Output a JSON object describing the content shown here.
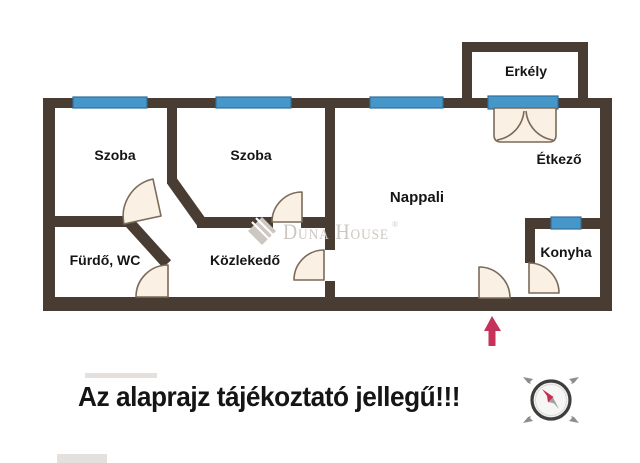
{
  "floorplan": {
    "rooms": [
      {
        "id": "szoba-1",
        "label": "Szoba"
      },
      {
        "id": "szoba-2",
        "label": "Szoba"
      },
      {
        "id": "nappali",
        "label": "Nappali"
      },
      {
        "id": "erkely",
        "label": "Erkély"
      },
      {
        "id": "etkezo",
        "label": "Étkező"
      },
      {
        "id": "furdo-wc",
        "label": "Fürdő, WC"
      },
      {
        "id": "kozlekedo",
        "label": "Közlekedő"
      },
      {
        "id": "konyha",
        "label": "Konyha"
      }
    ],
    "watermark": {
      "brand": "Duna House",
      "registered": "®"
    },
    "disclaimer": "Az alaprajz tájékoztató jellegű!!!",
    "colors": {
      "wall": "#493d33",
      "window_fill": "#4697c9",
      "window_border": "#2f6f9d",
      "door_fill": "#faf0e4",
      "door_stroke": "#7b6a5a",
      "entrance_arrow": "#c5325a",
      "label_text": "#151515",
      "watermark": "#cdc7c1",
      "compass_ring": "#3e3e3e",
      "compass_needle_red": "#cc2b4e",
      "compass_needle_gray": "#a3a19e"
    }
  }
}
